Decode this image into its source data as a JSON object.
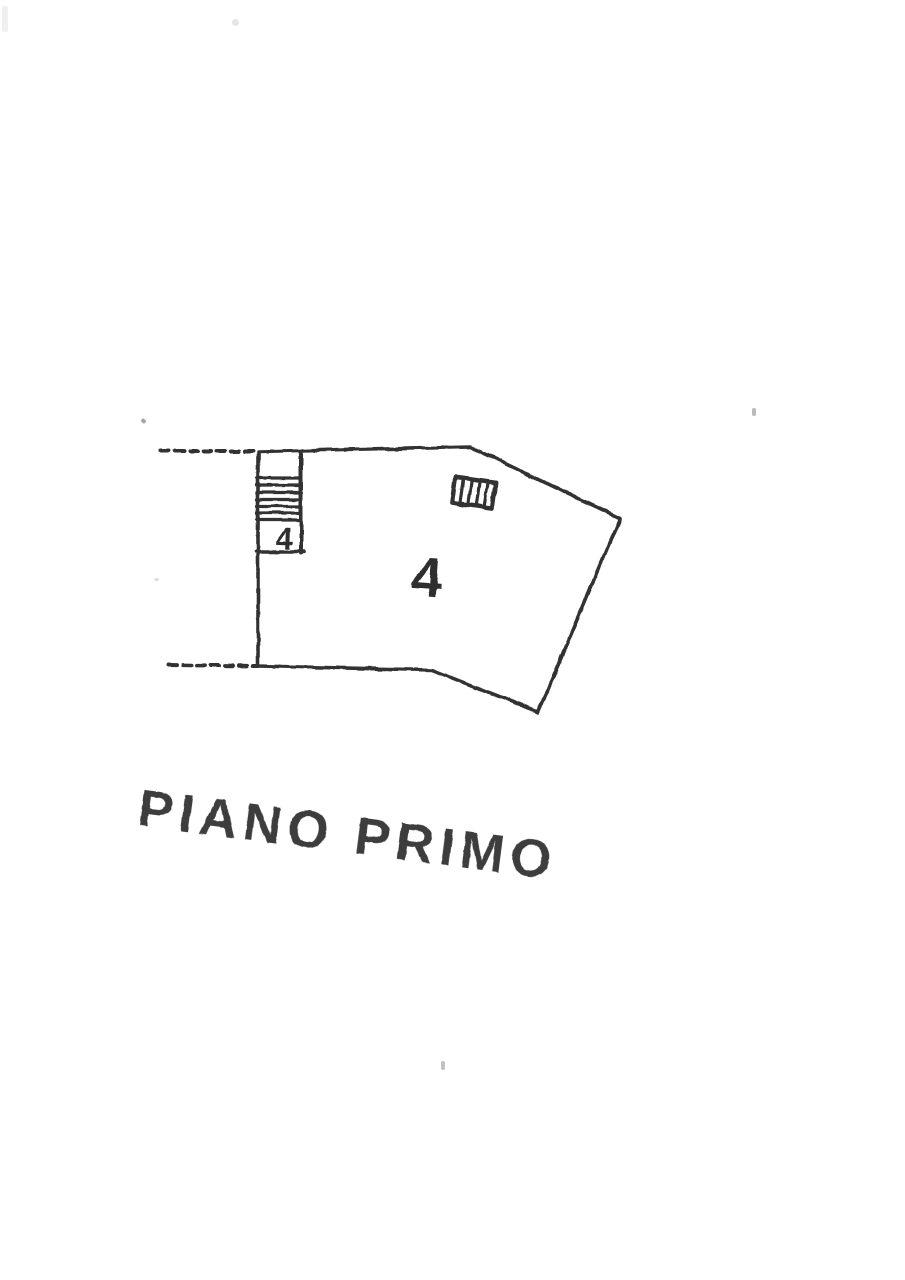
{
  "page": {
    "background_color": "#ffffff",
    "ink_color": "#333333"
  },
  "floorplan": {
    "title": "PIANO PRIMO",
    "main_room_label": "4",
    "stair_unit_label": "4",
    "symbols": {
      "stairs": "stairs-symbol",
      "flue": "hatched-flue-symbol",
      "party_walls": "dashed-wall-lines"
    }
  }
}
